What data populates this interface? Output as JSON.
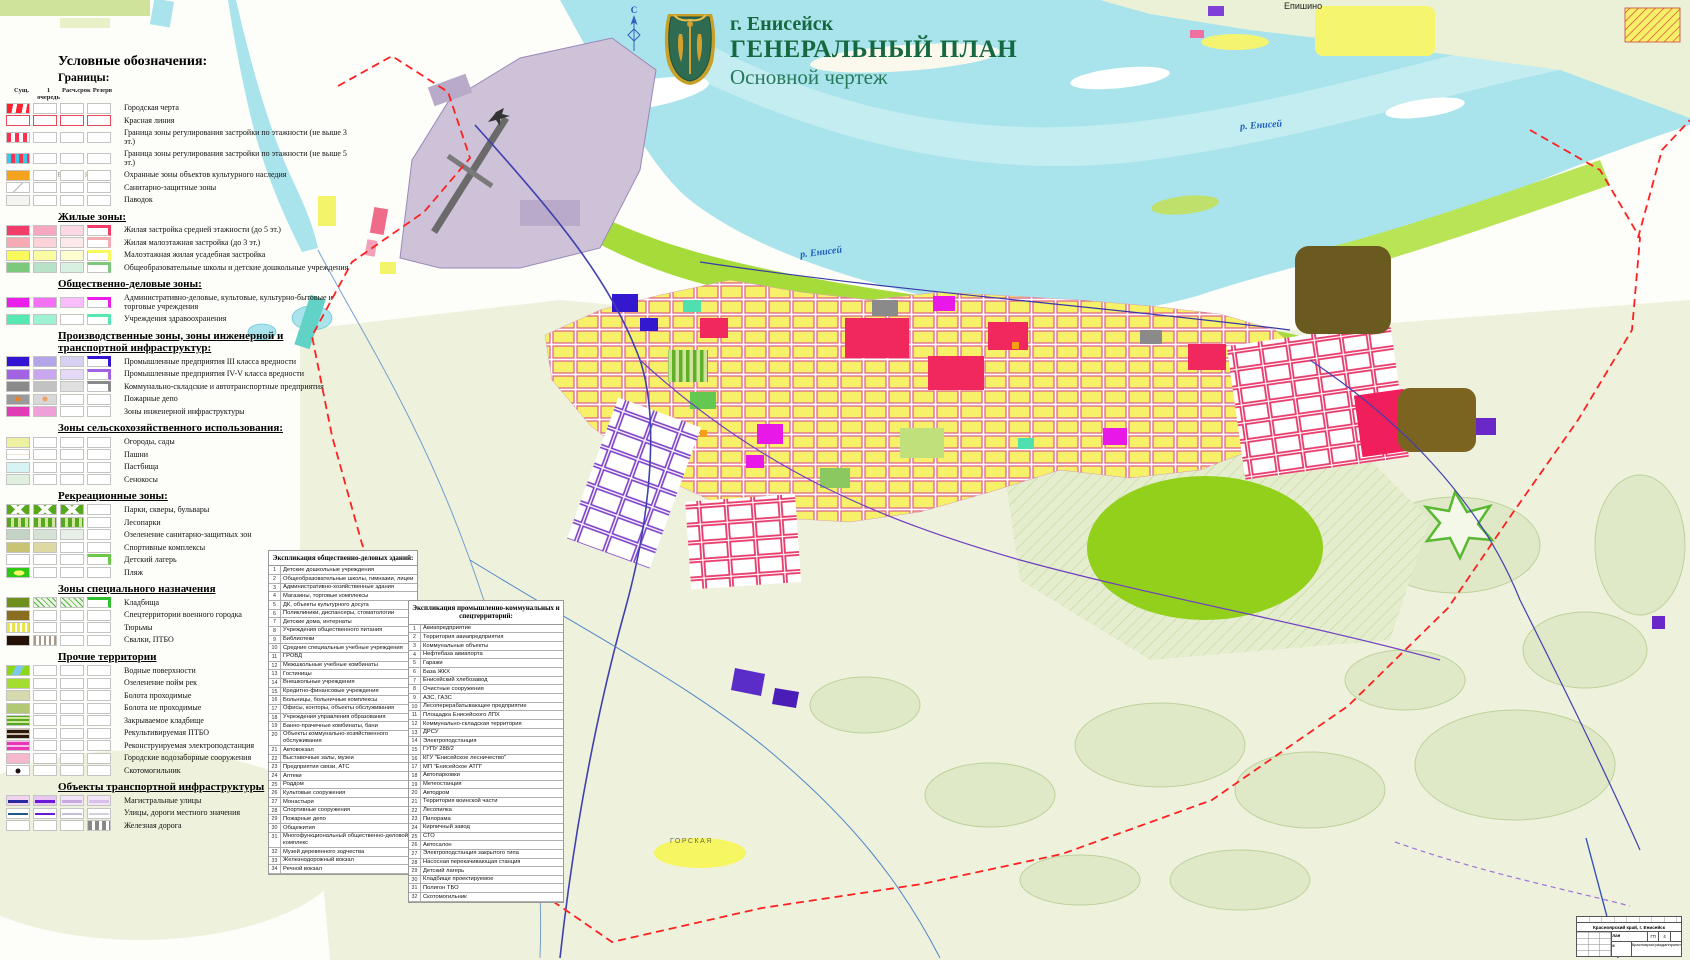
{
  "header": {
    "city": "г. Енисейск",
    "title": "ГЕНЕРАЛЬНЫЙ ПЛАН",
    "subtitle": "Основной чертеж",
    "title_color": "#15683f"
  },
  "map": {
    "compass": "С",
    "river_label": "р. Енисей",
    "settlement": "Епишино",
    "district": "ГОРСКАЯ",
    "lake_area": "ОЗЕРНАЯ",
    "boundary_color": "#ff2020",
    "water_color": "#a9e4ec"
  },
  "legend": {
    "heading": "Условные обозначения:",
    "subheading": "Границы:",
    "columns": [
      "Сущ.",
      "1 очередь",
      "Расч.срок",
      "Резерв"
    ],
    "sections": [
      {
        "header": null,
        "show_columns": true,
        "items": [
          {
            "label": "Городская черта",
            "sw": [
              "repeating-linear-gradient(100deg,#ff2030 0 6px,#ffffff 6px 10px)",
              "",
              "",
              ""
            ]
          },
          {
            "label": "Красная линия",
            "sw": [
              "ol:#e84858",
              "ol:#e84858",
              "ol:#e84858",
              "ol:#e84858"
            ]
          },
          {
            "label": "Граница зоны регулирования застройки по этажности (не выше 3 эт.)",
            "sw": [
              "repeating-linear-gradient(90deg,#ff3050 0 4px,#ffffff 4px 8px)",
              "",
              "",
              ""
            ]
          },
          {
            "label": "Граница зоны регулирования застройки по этажности (не выше 5 эт.)",
            "sw": [
              "repeating-linear-gradient(90deg,#38c8e8 0 4px,#ff3050 4px 8px)",
              "",
              "",
              ""
            ]
          },
          {
            "label": "Охранные зоны объектов культурного наследия",
            "sw": [
              "#f5a21e",
              "",
              "",
              ""
            ]
          },
          {
            "label": "Санитарно-защитные зоны",
            "sw": [
              "linear-gradient(135deg,#ffffff 46%,#c0c0c0 48% 52%,#ffffff 54%)",
              "",
              "",
              ""
            ]
          },
          {
            "label": "Паводок",
            "sw": [
              "#f4f4f0",
              "",
              "",
              ""
            ]
          }
        ]
      },
      {
        "header": "Жилые зоны:",
        "items": [
          {
            "label": "Жилая застройка средней этажности (до 5 эт.)",
            "sw": [
              "#f23c6a",
              "#f7a8c0",
              "#fbd8e4",
              "cb:#f23c6a"
            ]
          },
          {
            "label": "Жилая малоэтажная застройка (до 3 эт.)",
            "sw": [
              "#f5aab4",
              "#fad2d8",
              "#fde9ec",
              "cb:#f5aab4"
            ]
          },
          {
            "label": "Малоэтажная жилая усадебная застройка",
            "sw": [
              "#f9f95c",
              "#fbfba0",
              "#fdfdd0",
              "cb:#f9f95c"
            ]
          },
          {
            "label": "Общеобразовательные школы и детские дошкольные учреждения",
            "sw": [
              "#7cc87c",
              "#b8e2c8",
              "#d8f0e0",
              "cb:#7cc87c"
            ]
          }
        ]
      },
      {
        "header": "Общественно-деловые зоны:",
        "items": [
          {
            "label": "Административно-деловые, культовые, культурно-бытовые и торговые учреждения",
            "sw": [
              "#ea1eea",
              "#f470f4",
              "#fabcfa",
              "cb:#ea1eea"
            ]
          },
          {
            "label": "Учреждения здравоохранения",
            "sw": [
              "#55e8b0",
              "#9cf2d2",
              "",
              "cb:#55e8b0"
            ]
          }
        ]
      },
      {
        "header": "Производственные зоны, зоны инженерной и транспортной инфраструктур:",
        "items": [
          {
            "label": "Промышленные предприятия III класса вредности",
            "sw": [
              "#3214d2",
              "#b4a4e8",
              "#d8d0f2",
              "cb:#3214d2"
            ]
          },
          {
            "label": "Промышленные предприятия IV-V класса вредности",
            "sw": [
              "#a262e2",
              "#c9a6ee",
              "#e6d8f8",
              "cb:#a262e2"
            ]
          },
          {
            "label": "Коммунально-складские и автотранспортные предприятия",
            "sw": [
              "#8a8a8a",
              "#c2c2c2",
              "#e0e0e0",
              "cb:#8a8a8a"
            ]
          },
          {
            "label": "Пожарные депо",
            "sw": [
              "dot:#9a9a9a,#f08020",
              "dot:#d8d8d8,#f0a060",
              "",
              ""
            ]
          },
          {
            "label": "Зоны инженерной инфраструктуры",
            "sw": [
              "#e23cb4",
              "#f0a0d8",
              "",
              ""
            ]
          }
        ]
      },
      {
        "header": "Зоны сельскохозяйственного использования:",
        "items": [
          {
            "label": "Огороды, сады",
            "sw": [
              "#eef2a0",
              "",
              "",
              ""
            ]
          },
          {
            "label": "Пашни",
            "sw": [
              "repeating-linear-gradient(0deg,#ffffff 0 4px,#eee4d0 4px 5px)",
              "",
              "",
              ""
            ]
          },
          {
            "label": "Пастбища",
            "sw": [
              "#d8f3f3",
              "",
              "",
              ""
            ]
          },
          {
            "label": "Сенокосы",
            "sw": [
              "#dff0df",
              "",
              "",
              ""
            ]
          }
        ]
      },
      {
        "header": "Рекреационные зоны:",
        "items": [
          {
            "label": "Парки, скверы, бульвары",
            "sw": [
              "linear-gradient(45deg,transparent 40%,#ffffff 41% 59%,transparent 60%),linear-gradient(-45deg,#57a81e 40%,#ffffff 41% 59%,#57a81e 60%)",
              "linear-gradient(45deg,transparent 40%,#ffffff 41% 59%,transparent 60%),linear-gradient(-45deg,#57a81e 40%,#ffffff 41% 59%,#57a81e 60%)",
              "linear-gradient(45deg,transparent 40%,#ffffff 41% 59%,transparent 60%),linear-gradient(-45deg,#57a81e 40%,#ffffff 41% 59%,#57a81e 60%)",
              ""
            ]
          },
          {
            "label": "Лесопарки",
            "sw": [
              "repeating-linear-gradient(90deg,#57a81e 0 4px,#cfe89a 4px 7px)",
              "repeating-linear-gradient(90deg,#57a81e 0 4px,#cfe89a 4px 7px)",
              "repeating-linear-gradient(90deg,#57a81e 0 4px,#cfe89a 4px 7px)",
              ""
            ]
          },
          {
            "label": "Озеленение санитарно-защитных зон",
            "sw": [
              "#c4d4c4",
              "#d6e2d6",
              "#e8efe8",
              ""
            ]
          },
          {
            "label": "Спортивные комплексы",
            "sw": [
              "#c9c474",
              "#ded9a2",
              "",
              ""
            ]
          },
          {
            "label": "Детский лагерь",
            "sw": [
              "",
              "",
              "",
              "cb:#6cc848"
            ]
          },
          {
            "label": "Пляж",
            "sw": [
              "radial-gradient(ellipse 60% 70% at 55% 55%,#f8f860 0 40%,#2cc814 41%)",
              "",
              "",
              ""
            ]
          }
        ]
      },
      {
        "header": "Зоны специального назначения",
        "items": [
          {
            "label": "Кладбища",
            "sw": [
              "#6f8f1f",
              "repeating-linear-gradient(45deg,#eef6e6 0 3px,#50b040 3px 4px)",
              "repeating-linear-gradient(45deg,#eef6e6 0 3px,#50b040 3px 4px)",
              "cb:#30c030"
            ]
          },
          {
            "label": "Спецтерритории военного городка",
            "sw": [
              "#8a6d1e",
              "",
              "",
              ""
            ]
          },
          {
            "label": "Тюрьмы",
            "sw": [
              "repeating-linear-gradient(90deg,#e8e44a 0 3px,#ffffff 3px 5px),repeating-linear-gradient(0deg,#d8d43a 0 3px,#ffffff 3px 5px)",
              "",
              "",
              ""
            ]
          },
          {
            "label": "Свалки, ПТБО",
            "sw": [
              "#241206",
              "repeating-linear-gradient(90deg,#a89888 0 2px,#ffffff 2px 5px)",
              "",
              ""
            ]
          }
        ]
      },
      {
        "header": "Прочие территории",
        "items": [
          {
            "label": "Водные поверхности",
            "sw": [
              "linear-gradient(115deg,#8cd818 0 32%,#7ac8ee 36% 62%,#8cd818 66%)",
              "",
              "",
              ""
            ]
          },
          {
            "label": "Озеленение пойм рек",
            "sw": [
              "#a4dc30",
              "",
              "",
              ""
            ]
          },
          {
            "label": "Болота проходимые",
            "sw": [
              "#d6d9ae",
              "",
              "",
              ""
            ]
          },
          {
            "label": "Болота не проходимые",
            "sw": [
              "#b2c874",
              "",
              "",
              ""
            ]
          },
          {
            "label": "Закрываемое кладбище",
            "sw": [
              "repeating-linear-gradient(0deg,#58a820 0 2px,#cfe89a 2px 4px)",
              "",
              "",
              ""
            ]
          },
          {
            "label": "Рекультивируемая ПТБО",
            "sw": [
              "repeating-linear-gradient(0deg,#2a1808 0 3px,#c8b8a8 3px 5px)",
              "",
              "",
              ""
            ]
          },
          {
            "label": "Реконструируемая электроподстанция",
            "sw": [
              "repeating-linear-gradient(0deg,#e838b8 0 3px,#f8c0e8 3px 5px)",
              "",
              "",
              ""
            ]
          },
          {
            "label": "Городские водозаборные сооружения",
            "sw": [
              "#f5b8cc",
              "",
              "",
              ""
            ]
          },
          {
            "label": "Скотомогильник",
            "sw": [
              "dot:#ffffff,#201010",
              "",
              "",
              ""
            ]
          }
        ]
      },
      {
        "header": "Объекты транспортной инфраструктуры",
        "items": [
          {
            "label": "Магистральные улицы",
            "sw": [
              "road:#f0d4f0,#2828a0",
              "road:#e8c8f0,#6a18d8",
              "road:#f4e4f8,#c8a8e0",
              "road:#f4e4f8,#d8c0e8"
            ]
          },
          {
            "label": "Улицы, дороги местного значения",
            "sw": [
              "road:#ffffff,#205888",
              "road:#ffffff,#6a18d8",
              "road:#ffffff,#c0c0d8",
              "road:#ffffff,#d0d0e0"
            ]
          },
          {
            "label": "Железная дорога",
            "sw": [
              "",
              "",
              "",
              "repeating-linear-gradient(90deg,#888888 0 4px,#ffffff 4px 7px)"
            ]
          }
        ]
      }
    ]
  },
  "expl1": {
    "title": "Экспликация общественно-деловых зданий:",
    "items": [
      "Детские дошкольные учреждения",
      "Общеобразовательные школы, гимназии, лицеи",
      "Административно-хозяйственные здания",
      "Магазины, торговые комплексы",
      "ДК, объекты культурного досуга",
      "Поликлиники, диспансеры, стоматологии",
      "Детские дома, интернаты",
      "Учреждения общественного питания",
      "Библиотеки",
      "Средние специальные учебные учреждения",
      "ГРОВД",
      "Межшкольные учебные комбинаты",
      "Гостиницы",
      "Внешкольные учреждения",
      "Кредитно-финансовые учреждения",
      "Больницы, больничные комплексы",
      "Офисы, конторы, объекты обслуживания",
      "Учреждения управления образования",
      "Банно-прачечные комбинаты, бани",
      "Объекты коммунально-хозяйственного обслуживания",
      "Автовокзал",
      "Выставочные залы, музеи",
      "Предприятия связи, АТС",
      "Аптеки",
      "Роддом",
      "Культовые сооружения",
      "Монастыри",
      "Спортивные сооружения",
      "Пожарные депо",
      "Общежития",
      "Многофункциональный общественно-деловой комплекс",
      "Музей деревянного зодчества",
      "Железнодорожный вокзал",
      "Речной вокзал"
    ]
  },
  "expl2": {
    "title": "Экспликация промышленно-коммунальных и спецтерриторий:",
    "items": [
      "Авиапредприятие",
      "Территория авиапредприятия",
      "Коммунальные объекты",
      "Нефтебаза авиапорта",
      "Гаражи",
      "База ЖКХ",
      "Енисейский хлебозавод",
      "Очистные сооружения",
      "АЗС, ГАЗС",
      "Лесоперерабатывающее предприятие",
      "Площадка Енисейского ЛПХ",
      "Коммунально-складская территория",
      "ДРСУ",
      "Электроподстанция",
      "ГУПУ 288/2",
      "КГУ \"Енисейское лесничество\"",
      "МП \"Енисейское АТП\"",
      "Автопарковки",
      "Метеостанция",
      "Автодром",
      "Территория воинской части",
      "Лесопилка",
      "Пилорама",
      "Кирпичный завод",
      "СТО",
      "Автосалон",
      "Электроподстанция закрытого типа",
      "Насосная перекачивающая станция",
      "Детский лагерь",
      "Кладбище проектируемое",
      "Полигон ТБО",
      "Скотомогильник"
    ]
  },
  "stamp": {
    "region": "Красноярский край, г. Енисейск",
    "project": "Генеральный план",
    "stage": "ГП",
    "sheet": "4",
    "drawing": "Основной чертеж",
    "org": "Красноярскгражданпроект"
  }
}
